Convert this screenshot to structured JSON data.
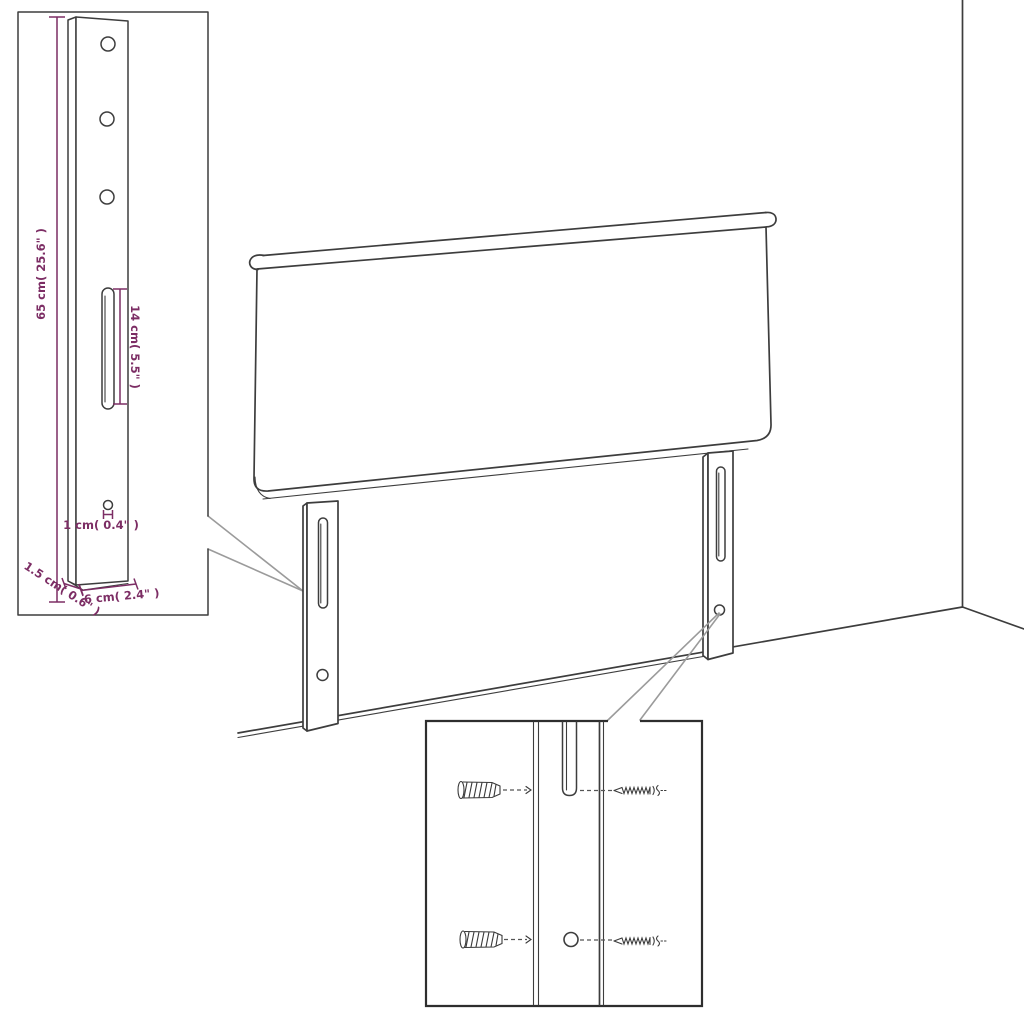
{
  "title": "Headboard mounting-leg dimension diagram",
  "labels": {
    "bracket_height": "65 cm( 25.6\" )",
    "slot_length": "14 cm( 5.5\" )",
    "hole_diameter": "1 cm( 0.4\" )",
    "bracket_depth": "1.5 cm( 0.6\" )",
    "bracket_width": "6 cm( 2.4\" )"
  },
  "figures": {
    "inset": "mounting-leg-dimension-detail",
    "main": "headboard-back-view-with-legs",
    "detail": "wall-anchor-and-screw-detail"
  },
  "colors": {
    "line": "#3d3d3d",
    "dimension_accent": "#7c2d64",
    "leader_gray": "#9b9b9b",
    "detail_box_border": "#2e2e2e",
    "background": "#ffffff"
  }
}
